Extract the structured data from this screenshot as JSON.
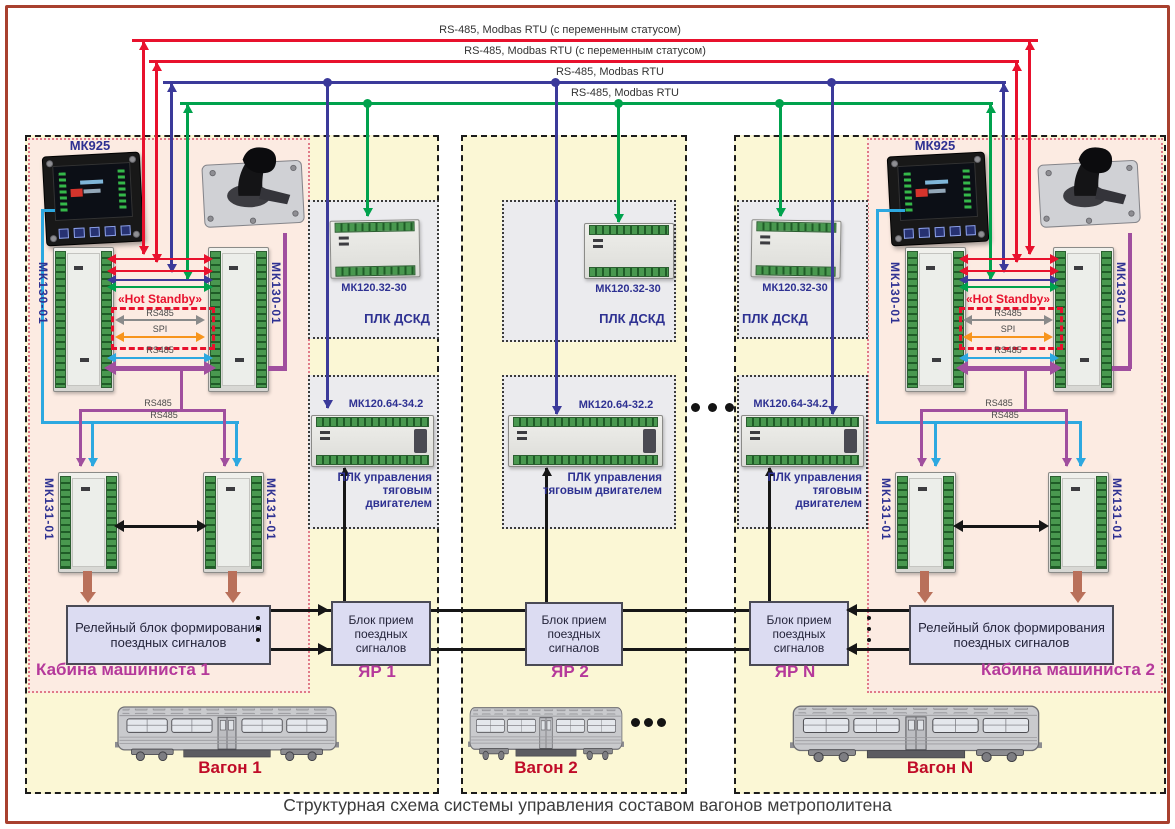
{
  "buses": {
    "b1": "RS-485, Modbas RTU (с переменным статусом)",
    "b2": "RS-485, Modbas RTU (с переменным статусом)",
    "b3": "RS-485, Modbas RTU",
    "b4": "RS-485, Modbas RTU"
  },
  "colors": {
    "bus_red": "#e8112d",
    "bus_blue": "#3b3a9a",
    "bus_green": "#00a24d",
    "rs485_lightblue": "#2da8e0",
    "rs485_purple": "#a04f9e",
    "spi_orange": "#f7941d",
    "rs485_gray": "#8a8a8a",
    "brown_arrow": "#b9705a",
    "section_yellow": "#fbf7d5",
    "cab_pink": "#fcebe2",
    "label_blue": "#2e3192",
    "label_magenta": "#b5399b",
    "label_darkred": "#c00c28"
  },
  "cab1": {
    "title": "Кабина машиниста 1",
    "mk925_label": "МК925",
    "mk130_label": "МК130-01",
    "hot_standby": "«Hot Standby»",
    "rs485_mid": "RS485",
    "spi": "SPI",
    "rs485_low": "RS485",
    "rs485_p": "RS485",
    "rs485_b": "RS485",
    "mk131_label": "МК131-01",
    "relay": "Релейный блок формирования поездных сигналов"
  },
  "cab2": {
    "title": "Кабина машиниста 2",
    "mk925_label": "МК925",
    "mk130_label": "МК130-01",
    "hot_standby": "«Hot Standby»",
    "rs485_mid": "RS485",
    "spi": "SPI",
    "rs485_low": "RS485",
    "rs485_p": "RS485",
    "rs485_b": "RS485",
    "mk131_label": "МК131-01",
    "relay": "Релейный блок формирования поездных сигналов"
  },
  "yar1": {
    "name": "ЯР 1",
    "plc_dskd": "МК120.32-30",
    "dskd": "ПЛК ДСКД",
    "plc_traction": "МК120.64-34.2",
    "traction": "ПЛК управления тяговым двигателем",
    "receiver": "Блок прием поездных сигналов"
  },
  "yar2": {
    "name": "ЯР 2",
    "plc_dskd": "МК120.32-30",
    "dskd": "ПЛК ДСКД",
    "plc_traction": "МК120.64-32.2",
    "traction": "ПЛК управления тяговым двигателем",
    "receiver": "Блок прием поездных сигналов"
  },
  "yarn": {
    "name": "ЯР N",
    "plc_dskd": "МК120.32-30",
    "dskd": "ПЛК ДСКД",
    "plc_traction": "МК120.64-34.2",
    "traction": "ПЛК управления тяговым двигателем",
    "receiver": "Блок прием поездных сигналов"
  },
  "wagons": {
    "w1": "Вагон 1",
    "w2": "Вагон 2",
    "wn": "Вагон N"
  },
  "caption": "Структурная схема системы управления составом вагонов метрополитена"
}
